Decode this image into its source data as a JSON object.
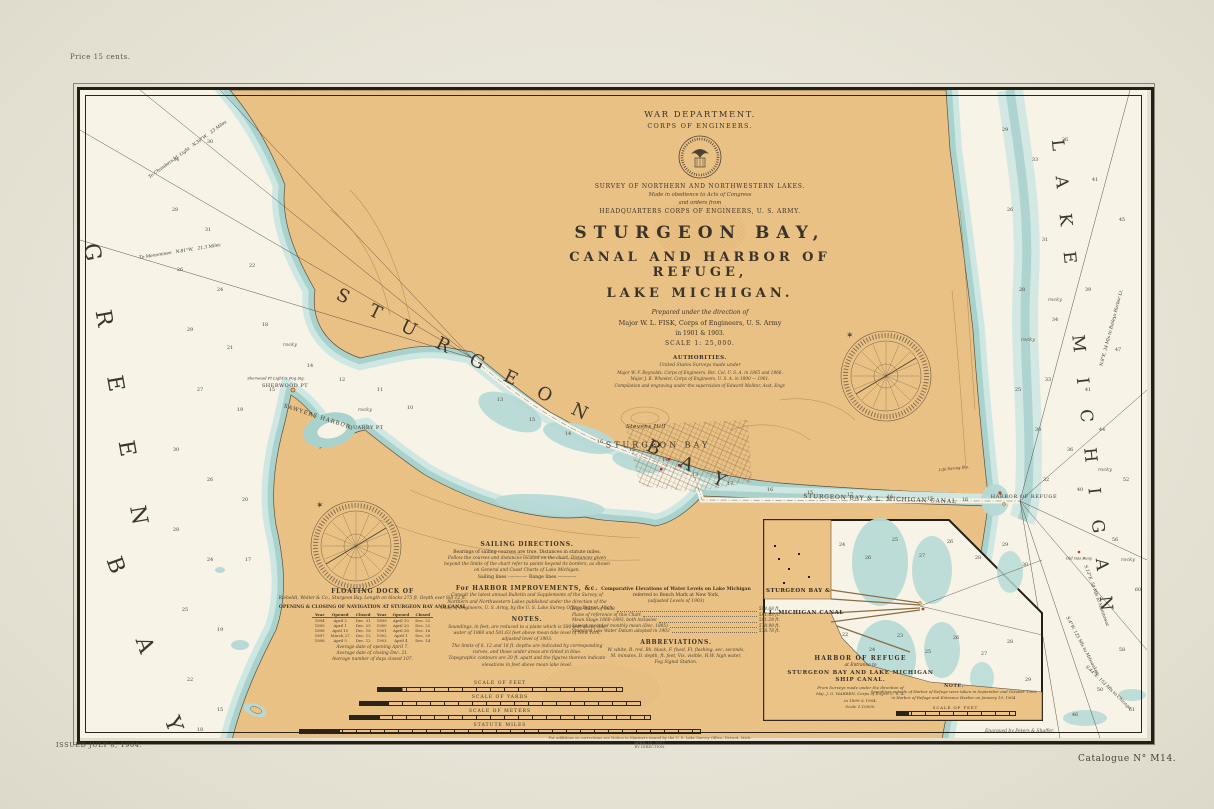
{
  "page": {
    "price": "Price 15 cents.",
    "issued": "ISSUED JULY 8, 1904.",
    "catalogue": "Catalogue N° M14.",
    "engraver": "Engraved by Peters & Shaffer.",
    "corr1": "For additions or corrections see Notice to Mariners issued by the U. S. Lake Survey Office, Detroit, Mich.",
    "corr2": "APRIL 15, 1907.",
    "corr3": "BY DIRECTION."
  },
  "title_block": {
    "dept": "WAR DEPARTMENT.",
    "corps": "CORPS OF ENGINEERS.",
    "survey": "SURVEY OF NORTHERN AND NORTHWESTERN LAKES.",
    "obedience": "Made in obedience to Acts of Congress",
    "orders": "and orders from",
    "hq": "HEADQUARTERS CORPS OF ENGINEERS, U. S. ARMY.",
    "title1": "STURGEON BAY,",
    "title2": "CANAL AND HARBOR OF REFUGE,",
    "title3": "LAKE MICHIGAN.",
    "prepared": "Prepared under the direction of",
    "major": "Major W. L. FISK, Corps of Engineers, U. S. Army",
    "years": "in 1901 & 1903.",
    "scale": "SCALE 1: 25,000.",
    "auth_h": "AUTHORITIES.",
    "auth_sub": "United States Surveys made under",
    "auth1": "Major W. F. Reynolds, Corps of Engineers, Bvt. Col. U. S. A. in 1865 and 1866.",
    "auth2": "Major J. B. Wheeler, Corps of Engineers, U. S. A. in 1890 — 1901.",
    "auth3": "Compilation and engraving under the supervision of Edward Molitor, Asst. Engr."
  },
  "sailing": {
    "h": "SAILING DIRECTIONS.",
    "l1": "Bearings of sailing courses are true.  Distances in statute miles.",
    "i1": "Follow the courses and distances located on the chart.  Distances given",
    "i2": "beyond the limits of the chart refer to points beyond its borders, as shown",
    "i3": "on General and Coast Charts of Lake Michigan.",
    "legend": "Sailing lines ·—·—·—·        Range lines ————",
    "h2": "For HARBOR IMPROVEMENTS, &c.",
    "j1": "Consult the latest annual Bulletin and Supplements of the Survey of",
    "j2": "Northern and Northwestern Lakes published under the direction of the",
    "j3": "Chief of Engineers, U. S. Army, by the U. S. Lake Survey Office, Detroit, Mich.",
    "nh": "NOTES.",
    "n1": "Soundings, in feet, are reduced to a plane which is 580 feet above tide",
    "n2": "water of 1860 and 581.63 feet above mean tide level of New York,",
    "n3": "adjusted level of 1903.",
    "n4": "The limits of 6, 12 and 18 ft. depths are indicated by corresponding",
    "n5": "curves, and those under areas are tinted in blue.",
    "n6": "Topographic contours are 20 ft. apart and the figures thereon indicate",
    "n7": "elevations in feet above mean lake level."
  },
  "elevations": {
    "h1": "Comparative Elevations of Water Levels on Lake Michigan",
    "h2": "referred to Bench Mark at New York,",
    "h3": "(adjusted Levels of 1903)",
    "rows": [
      [
        "High Water of 1838",
        "584.68 ft."
      ],
      [
        "Plane of reference of this Chart",
        "581.63 ft."
      ],
      [
        "Mean Stage 1860–1893, both inclusive",
        "581.28 ft."
      ],
      [
        "Lowest recorded monthly mean (Dec. 1895)",
        "578.98 ft."
      ],
      [
        "Standard Low Water Datum adopted in 1903",
        "578.78 ft."
      ]
    ],
    "abbr_h": "ABBREVIATIONS.",
    "abbr1": "W. white,  R. red,  Bk. black,  F. fixed,  Fl. flashing,  sec. seconds,",
    "abbr2": "M. minutes,  D. depth,  ft. feet,  Vis. visible,  H.W. high water,",
    "abbr3": "Fog Signal Station."
  },
  "dock": {
    "h": "FLOATING DOCK OF",
    "l1": "Rieboldt, Wolter & Co., Sturgeon Bay.  Length on blocks 275 ft.  Depth over Sill 12 ft.",
    "table_h": "OPENING & CLOSING OF NAVIGATION AT STURGEON BAY AND CANAL",
    "cols": [
      "Year",
      "Opened",
      "Closed",
      "Year",
      "Opened",
      "Closed"
    ],
    "rows": [
      [
        "1894",
        "April 2",
        "Dec. 31",
        "1899",
        "April 10",
        "Dec. 22"
      ],
      [
        "1895",
        "April 1",
        "Dec. 25",
        "1900",
        "April 20",
        "Dec. 22"
      ],
      [
        "1896",
        "April 10",
        "Dec. 18",
        "1901",
        "April 28",
        "Dec. 16"
      ],
      [
        "1897",
        "March 27",
        "Dec. 12",
        "1902",
        "April 1",
        "Dec. 20"
      ],
      [
        "1898",
        "April 5",
        "Dec. 12",
        "1903",
        "April 4",
        "Dec. 14"
      ]
    ],
    "f1": "Average date of opening April 7.",
    "f2": "Average date of closing Dec. 21.",
    "f3": "Average number of days closed 107."
  },
  "scales": {
    "feet": "SCALE OF FEET",
    "yards": "SCALE OF YARDS",
    "meters": "SCALE OF METERS",
    "miles": "STATUTE MILES"
  },
  "inset": {
    "label1": "STURGEON BAY &",
    "label2": "L. MICHIGAN CANAL",
    "t1": "HARBOR OF REFUGE",
    "t2": "at Entrance to",
    "t3": "STURGEON BAY AND LAKE MICHIGAN",
    "t4": "SHIP CANAL.",
    "s1": "From Surveys made under the direction of",
    "s2": "Maj. J. G. WARREN, Corps of Engrs. U. S. A.",
    "s3": "in 1899 & 1904.",
    "s4": "Scale 1:10000.",
    "note_h": "NOTE.",
    "note1": "Soundings outside of Harbor of Refuge were taken in September and October 1903;",
    "note2": "in Harbor of Refuge and Entrance Harbor on January 19, 1904.",
    "scale_label": "SCALE OF FEET"
  },
  "colors": {
    "land": "#ecc386",
    "water": "#f7f3e6",
    "shallow": "#a9d2cd",
    "shallow_light": "#cfe7e2",
    "ink": "#241f16",
    "brown": "#8a6b46"
  },
  "sea_labels": [
    {
      "t": "G  R  E  E  N",
      "x": 36,
      "y": 300,
      "r": 80,
      "s": 22,
      "ls": 12
    },
    {
      "t": "B   A   Y",
      "x": 66,
      "y": 560,
      "r": 70,
      "s": 22,
      "ls": 12
    },
    {
      "t": "S T U R G E O N    B A Y",
      "x": 455,
      "y": 300,
      "r": 26,
      "s": 18,
      "ls": 9
    },
    {
      "t": "L A K E    M I C H I G A N",
      "x": 1002,
      "y": 290,
      "r": 84,
      "s": 17,
      "ls": 10
    },
    {
      "t": "STURGEON BAY",
      "x": 578,
      "y": 355,
      "r": 0,
      "s": 8,
      "ls": 3
    },
    {
      "t": "Stevens Hill",
      "x": 566,
      "y": 337,
      "r": 0,
      "s": 5.5,
      "ls": 0.5,
      "i": 1
    },
    {
      "t": "SHERWOOD PT",
      "x": 205,
      "y": 296,
      "r": 0,
      "s": 5,
      "ls": 0.5
    },
    {
      "t": "Sherwood Pt Light & Fog Sig.",
      "x": 196,
      "y": 288,
      "r": 0,
      "s": 3.8,
      "ls": 0,
      "i": 1
    },
    {
      "t": "SAWYERS HARBOR",
      "x": 237,
      "y": 327,
      "r": 18,
      "s": 5.5,
      "ls": 1
    },
    {
      "t": "QUARRY PT",
      "x": 286,
      "y": 338,
      "r": 0,
      "s": 5,
      "ls": 0.5
    },
    {
      "t": "STURGEON BAY & L. MICHIGAN CANAL",
      "x": 800,
      "y": 409,
      "r": 2,
      "s": 6,
      "ls": 0.8
    },
    {
      "t": "HARBOR OF REFUGE",
      "x": 944,
      "y": 407,
      "r": 0,
      "s": 5,
      "ls": 0.6
    },
    {
      "t": "Life Saving Sta.",
      "x": 874,
      "y": 378,
      "r": -6,
      "s": 3.8,
      "ls": 0,
      "i": 1
    },
    {
      "t": "Old Gas Buoy",
      "x": 999,
      "y": 468,
      "r": 0,
      "s": 3.8,
      "ls": 0,
      "i": 1
    },
    {
      "t": "To Menominee   N.81°W.   21.3 Miles",
      "x": 100,
      "y": 162,
      "r": -9,
      "s": 4.4,
      "ls": 0,
      "i": 1
    },
    {
      "t": "To Chambers Id. Light   N.30°W.   23 Miles",
      "x": 108,
      "y": 60,
      "r": -36,
      "s": 4.4,
      "ls": 0,
      "i": 1
    },
    {
      "t": "S.4°W. 125 Mls to Milwaukee",
      "x": 1002,
      "y": 556,
      "r": 62,
      "s": 4.4,
      "ls": 0,
      "i": 1
    },
    {
      "t": "S.44°E. 153 Mls to Chicago",
      "x": 1028,
      "y": 598,
      "r": 44,
      "s": 4.4,
      "ls": 0,
      "i": 1
    },
    {
      "t": "S.13°E. 50 Mls to Manitowoc",
      "x": 1016,
      "y": 506,
      "r": 70,
      "s": 4.4,
      "ls": 0,
      "i": 1
    },
    {
      "t": "N.8°E. 34 Mls to Baileys Harbor Lt.",
      "x": 1032,
      "y": 238,
      "r": -75,
      "s": 4.4,
      "ls": 0,
      "i": 1
    }
  ],
  "soundings": [
    [
      96,
      70,
      "34"
    ],
    [
      130,
      52,
      "30"
    ],
    [
      95,
      120,
      "28"
    ],
    [
      128,
      140,
      "31"
    ],
    [
      100,
      180,
      "26"
    ],
    [
      140,
      200,
      "24"
    ],
    [
      172,
      176,
      "22"
    ],
    [
      110,
      240,
      "29"
    ],
    [
      150,
      258,
      "21"
    ],
    [
      185,
      235,
      "18"
    ],
    [
      120,
      300,
      "27"
    ],
    [
      160,
      320,
      "19"
    ],
    [
      192,
      300,
      "15"
    ],
    [
      230,
      276,
      "14"
    ],
    [
      262,
      290,
      "12"
    ],
    [
      300,
      300,
      "11"
    ],
    [
      330,
      318,
      "10"
    ],
    [
      96,
      360,
      "30"
    ],
    [
      130,
      390,
      "26"
    ],
    [
      165,
      410,
      "20"
    ],
    [
      96,
      440,
      "28"
    ],
    [
      130,
      470,
      "24"
    ],
    [
      168,
      470,
      "17"
    ],
    [
      105,
      520,
      "25"
    ],
    [
      140,
      540,
      "19"
    ],
    [
      110,
      590,
      "22"
    ],
    [
      140,
      620,
      "15"
    ],
    [
      120,
      640,
      "18"
    ],
    [
      210,
      255,
      "rocky",
      1
    ],
    [
      285,
      320,
      "rocky",
      1
    ],
    [
      420,
      310,
      "13"
    ],
    [
      452,
      330,
      "15"
    ],
    [
      488,
      344,
      "14"
    ],
    [
      520,
      352,
      "16"
    ],
    [
      552,
      360,
      "15"
    ],
    [
      585,
      370,
      "14"
    ],
    [
      615,
      385,
      "13"
    ],
    [
      650,
      394,
      "17"
    ],
    [
      690,
      400,
      "16"
    ],
    [
      730,
      403,
      "15"
    ],
    [
      770,
      405,
      "17"
    ],
    [
      810,
      407,
      "16"
    ],
    [
      850,
      409,
      "15"
    ],
    [
      885,
      410,
      "16"
    ],
    [
      925,
      40,
      "29"
    ],
    [
      955,
      70,
      "33"
    ],
    [
      985,
      50,
      "36"
    ],
    [
      1015,
      90,
      "41"
    ],
    [
      1042,
      130,
      "45"
    ],
    [
      930,
      120,
      "26"
    ],
    [
      965,
      150,
      "31"
    ],
    [
      942,
      200,
      "28"
    ],
    [
      975,
      230,
      "34"
    ],
    [
      1008,
      200,
      "39"
    ],
    [
      1038,
      260,
      "47"
    ],
    [
      1008,
      300,
      "41"
    ],
    [
      968,
      290,
      "33"
    ],
    [
      938,
      300,
      "25"
    ],
    [
      958,
      340,
      "30"
    ],
    [
      990,
      360,
      "36"
    ],
    [
      1022,
      340,
      "44"
    ],
    [
      1046,
      390,
      "52"
    ],
    [
      1000,
      400,
      "40"
    ],
    [
      966,
      390,
      "32"
    ],
    [
      1035,
      450,
      "56"
    ],
    [
      1058,
      500,
      "60"
    ],
    [
      1042,
      560,
      "58"
    ],
    [
      1020,
      600,
      "50"
    ],
    [
      995,
      625,
      "46"
    ],
    [
      1052,
      620,
      "61"
    ],
    [
      975,
      210,
      "rocky",
      1
    ],
    [
      1025,
      380,
      "rocky",
      1
    ],
    [
      948,
      250,
      "rocky",
      1
    ],
    [
      1048,
      470,
      "rocky",
      1
    ],
    [
      762,
      455,
      "24"
    ],
    [
      788,
      468,
      "26"
    ],
    [
      815,
      450,
      "25"
    ],
    [
      842,
      466,
      "27"
    ],
    [
      870,
      452,
      "26"
    ],
    [
      898,
      468,
      "28"
    ],
    [
      925,
      455,
      "29"
    ],
    [
      945,
      475,
      "30"
    ],
    [
      765,
      545,
      "22"
    ],
    [
      792,
      560,
      "24"
    ],
    [
      820,
      546,
      "23"
    ],
    [
      848,
      562,
      "25"
    ],
    [
      876,
      548,
      "26"
    ],
    [
      904,
      564,
      "27"
    ],
    [
      930,
      552,
      "28"
    ],
    [
      948,
      590,
      "29"
    ]
  ]
}
